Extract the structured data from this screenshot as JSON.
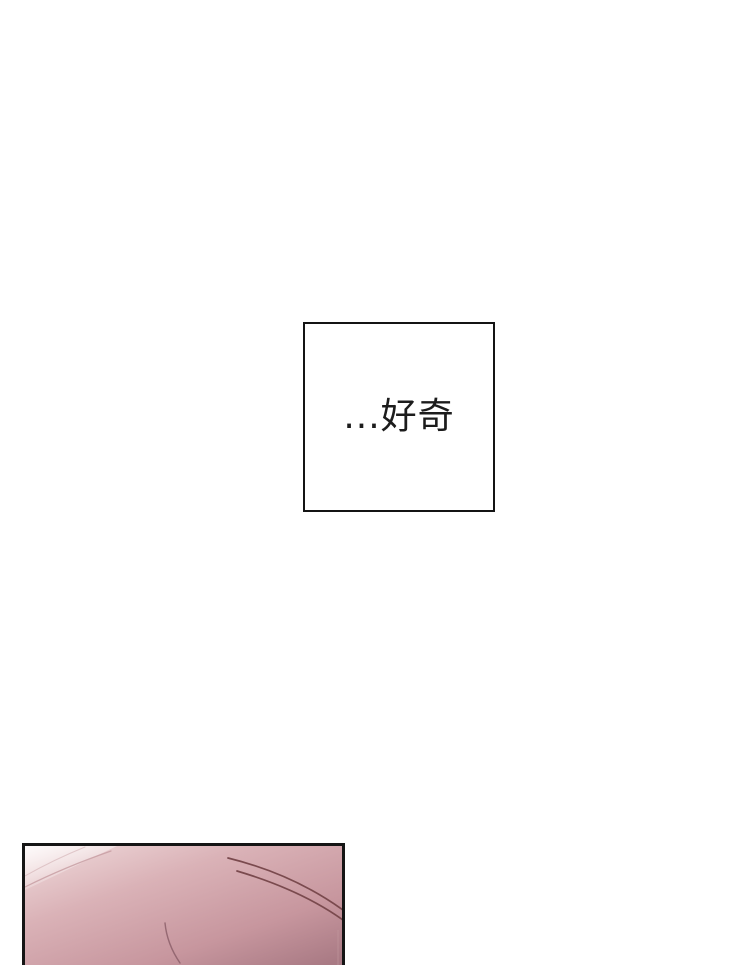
{
  "page": {
    "background": "#ffffff"
  },
  "caption_box": {
    "text": "...好奇",
    "text_color": "#1c1c1c",
    "border_color": "#141414"
  },
  "artwork_panel": {
    "alt": "close-up skin-toned gradient with stray hair strands, panel cropped by page bottom",
    "border_color": "#151515",
    "colors": {
      "highlight": "#fdfafa",
      "light": "#f0dbdc",
      "mid": "#dab2b7",
      "deep": "#c7969e",
      "shadow": "#a97a84",
      "strand_dark": "#7a4a4e",
      "strand_soft": "#8c5f6a",
      "strand_faint": "#c59ba0"
    }
  }
}
